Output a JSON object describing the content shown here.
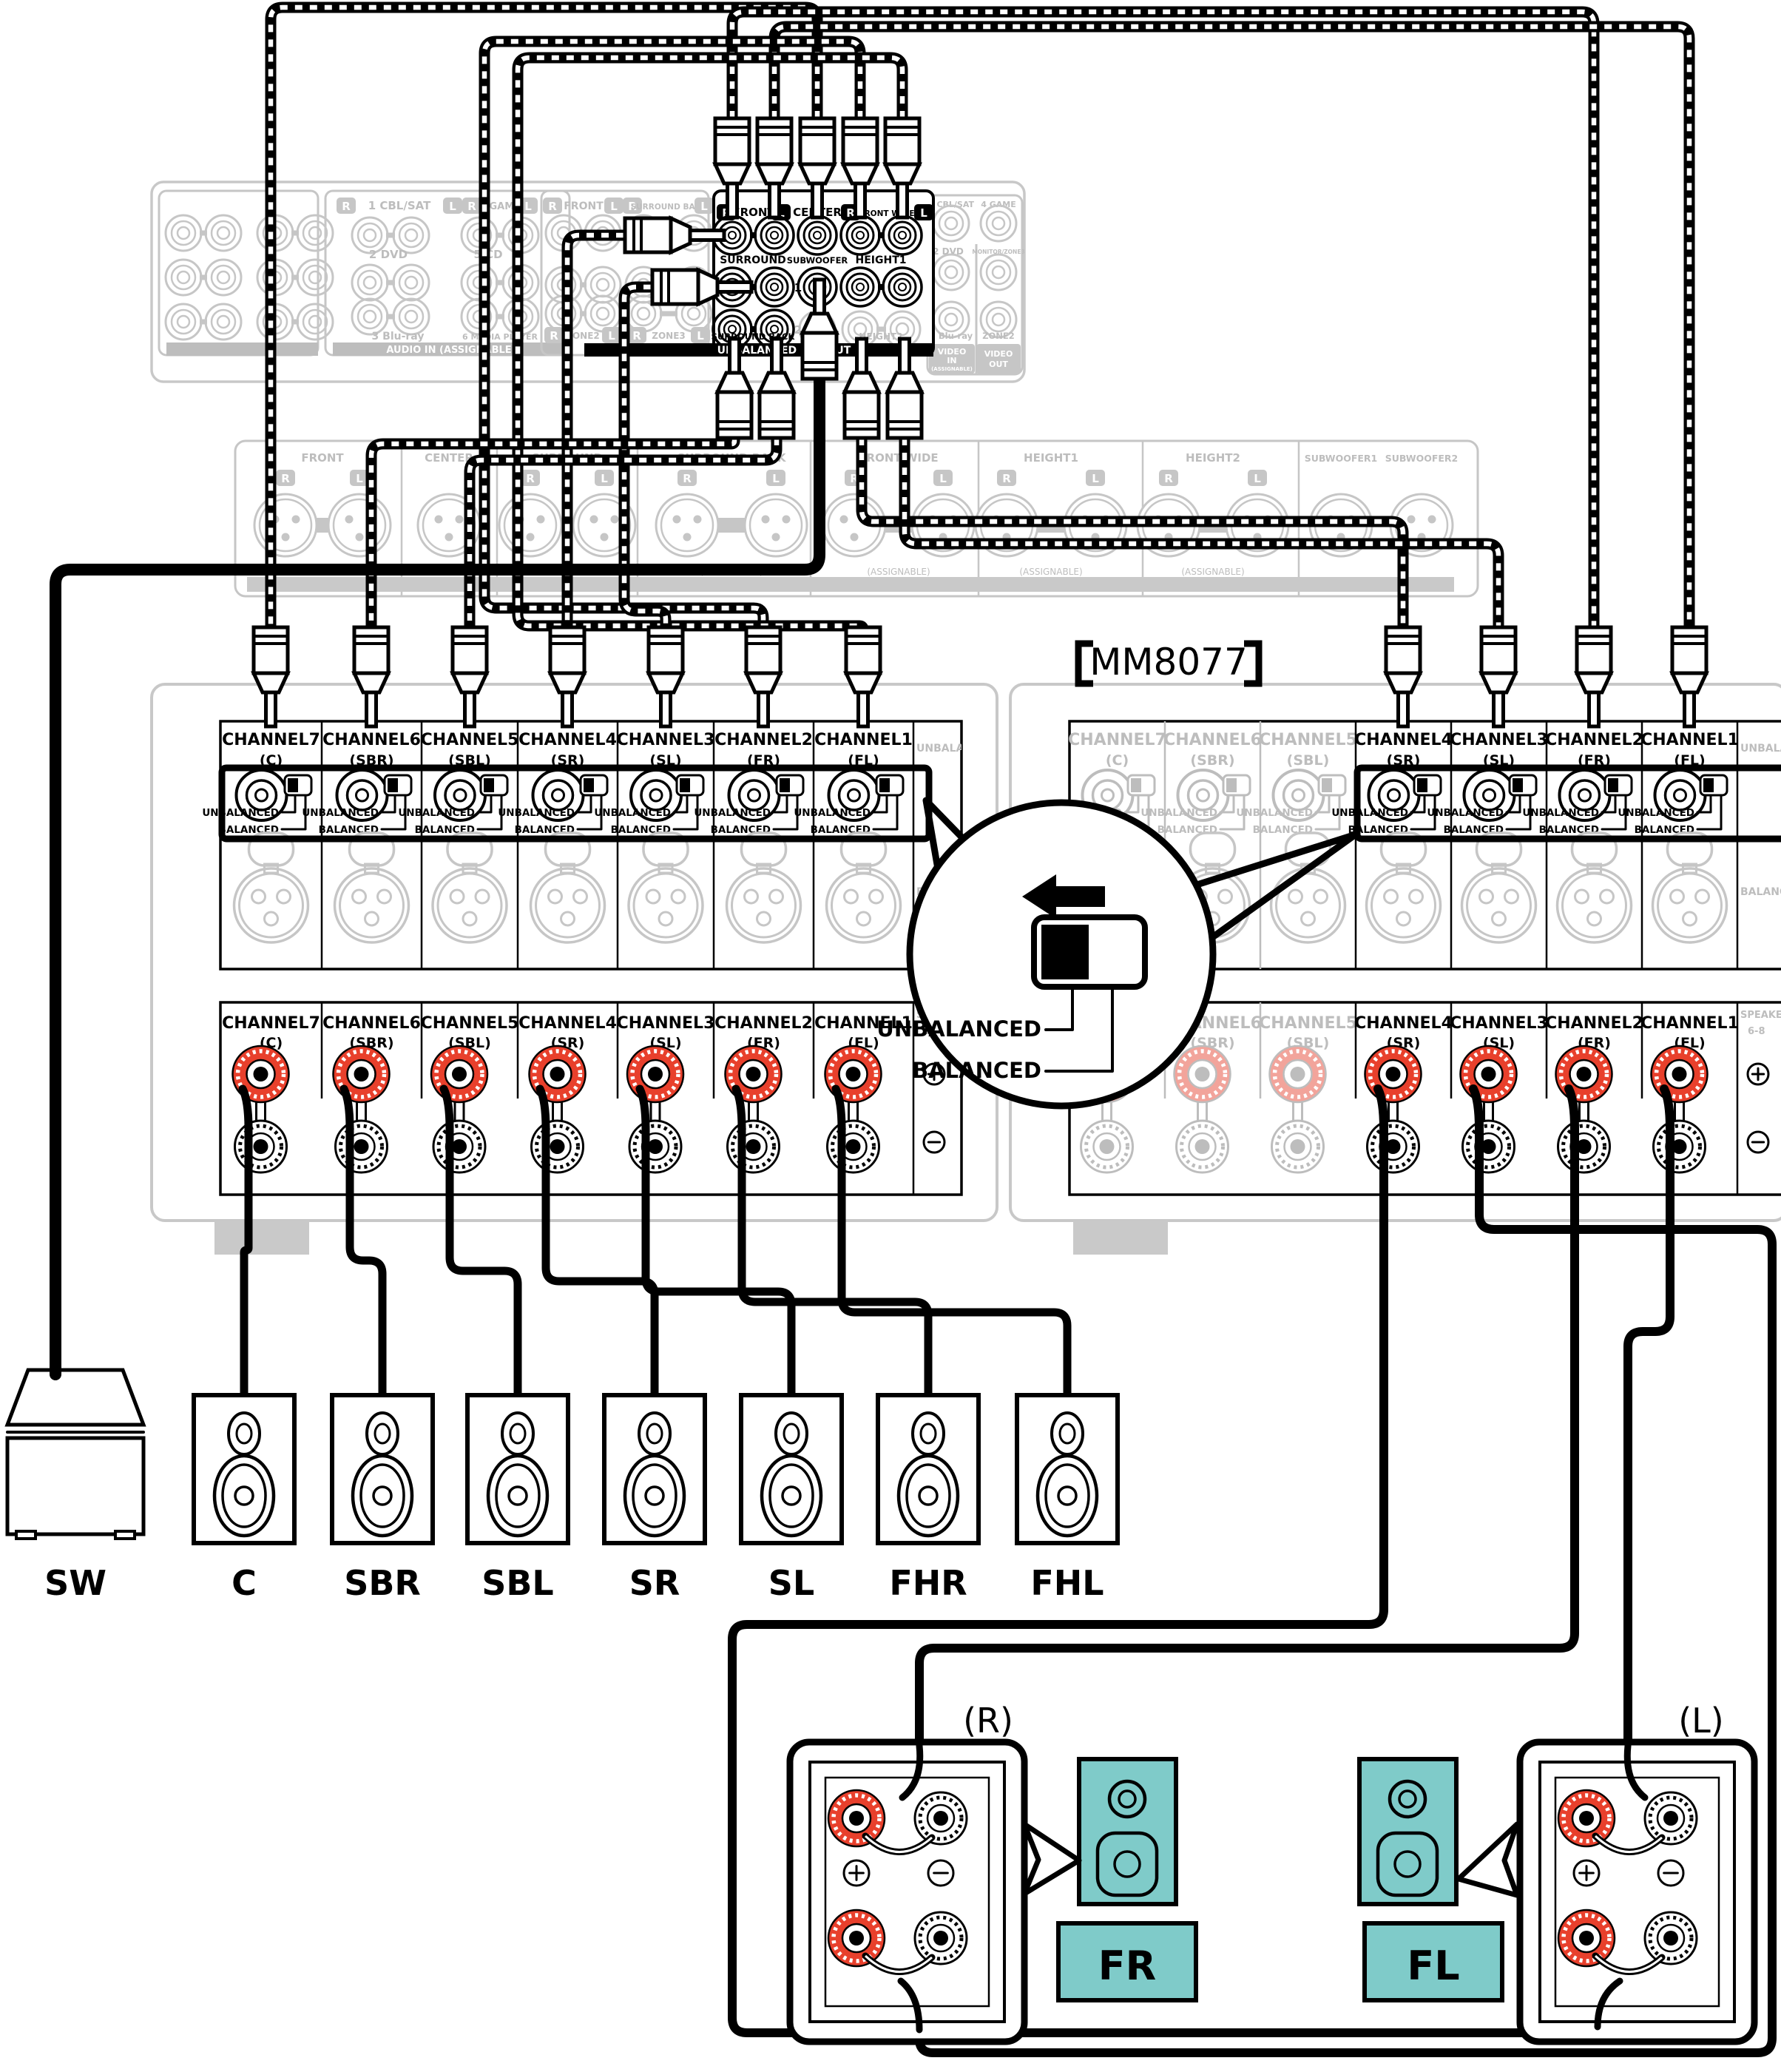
{
  "amp_label": "【 MM8077 】",
  "amp_label_text": "MM8077",
  "colors": {
    "red": "#E8402C",
    "red_inactive": "#F2A49B",
    "teal": "#7FCBC9",
    "panel_gray": "#C6C6C6",
    "text_gray": "#BDBDBD"
  },
  "preamp": {
    "audio_in": {
      "col1": [
        "1 CBL/SAT",
        "2 DVD",
        "3 Blu-ray"
      ],
      "col2": [
        "4 GAME",
        "5 CD",
        "6 MEDIA PLAYER"
      ],
      "bar": "AUDIO IN (ASSIGNABLE)",
      "r": "R",
      "l": "L"
    },
    "zone": {
      "front": "FRONT",
      "surround_back": "SURROUND BACK",
      "zone2": "ZONE2",
      "zone3": "ZONE3",
      "r": "R",
      "l": "L"
    },
    "pre_out": {
      "front": "FRONT",
      "center": "CENTER",
      "front_wide": "FRONT WIDE",
      "surround": "SURROUND",
      "subwoofer": "SUBWOOFER",
      "sub1": "1",
      "sub2": "2",
      "height1": "HEIGHT1",
      "surround_back": "SURROUND BACK",
      "height2": "HEIGHT2",
      "bar": "UNBALANCED PRE OUT",
      "r": "R",
      "l": "L"
    },
    "video": {
      "in1": "1 CBL/SAT",
      "in4": "4 GAME",
      "in2": "2 DVD",
      "monitor": "MONITOR/ZONE3",
      "in3": "3 Blu-ray",
      "zone2": "ZONE2",
      "video_in": "VIDEO IN",
      "assignable": "(ASSIGNABLE)",
      "video_out": "VIDEO OUT"
    },
    "xlr": {
      "sections": [
        "FRONT",
        "CENTER",
        "SURROUND",
        "SURROUND BACK",
        "FRONT WIDE",
        "HEIGHT1",
        "HEIGHT2",
        "SUBWOOFER1",
        "SUBWOOFER2"
      ],
      "assignable": "(ASSIGNABLE)",
      "r": "R",
      "l": "L"
    }
  },
  "amp": {
    "channels": [
      [
        "CHANNEL7",
        "(C)"
      ],
      [
        "CHANNEL6",
        "(SBR)"
      ],
      [
        "CHANNEL5",
        "(SBL)"
      ],
      [
        "CHANNEL4",
        "(SR)"
      ],
      [
        "CHANNEL3",
        "(SL)"
      ],
      [
        "CHANNEL2",
        "(FR)"
      ],
      [
        "CHANNEL1",
        "(FL)"
      ]
    ],
    "unbalanced": "UNBALANCED",
    "balanced": "BALANCED",
    "edge_unbalanced": "UNBALANCED",
    "edge_balanced": "BALANCED",
    "edge_speakers": "SPEAKERS",
    "edge_range": "6-8"
  },
  "callout": {
    "unbalanced": "UNBALANCED",
    "balanced": "BALANCED"
  },
  "speaker_labels": [
    "SW",
    "C",
    "SBR",
    "SBL",
    "SR",
    "SL",
    "FHR",
    "FHL"
  ],
  "front": {
    "r": "(R)",
    "l": "(L)",
    "fr": "FR",
    "fl": "FL",
    "plus": "+",
    "minus": "−"
  }
}
